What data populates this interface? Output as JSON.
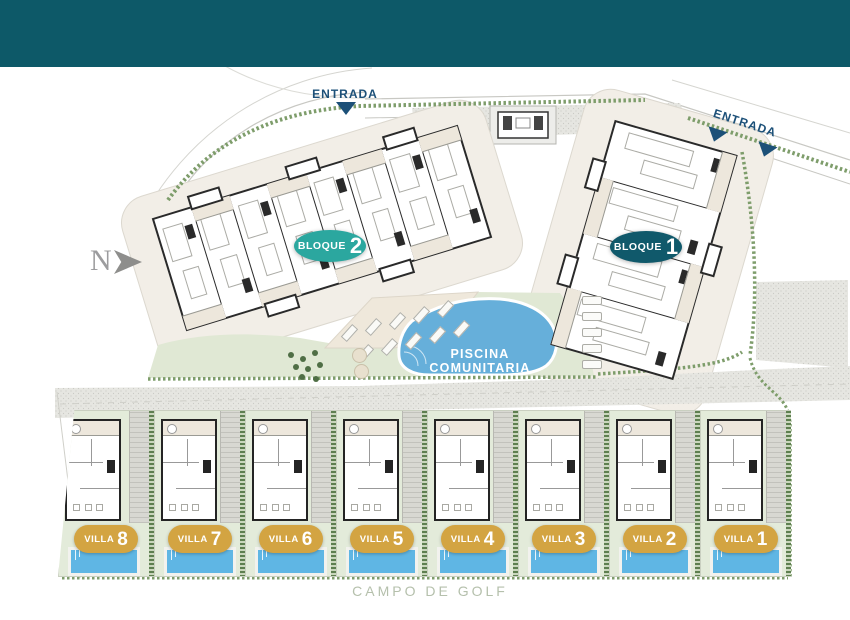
{
  "header": {
    "color": "#0D5968"
  },
  "compass": {
    "label": "N"
  },
  "entrances": [
    {
      "label": "ENTRADA"
    },
    {
      "label": "ENTRADA"
    }
  ],
  "blocks": [
    {
      "label": "BLOQUE",
      "number": "2",
      "color": "#2BA79F"
    },
    {
      "label": "BLOQUE",
      "number": "1",
      "color": "#10596B"
    }
  ],
  "pool": {
    "label": "PISCINA COMUNITARIA",
    "color": "#66AFDA"
  },
  "villas": [
    {
      "label": "VILLA",
      "number": "8"
    },
    {
      "label": "VILLA",
      "number": "7"
    },
    {
      "label": "VILLA",
      "number": "6"
    },
    {
      "label": "VILLA",
      "number": "5"
    },
    {
      "label": "VILLA",
      "number": "4"
    },
    {
      "label": "VILLA",
      "number": "3"
    },
    {
      "label": "VILLA",
      "number": "2"
    },
    {
      "label": "VILLA",
      "number": "1"
    }
  ],
  "villa_badge_color": "#D3A442",
  "golf": {
    "label": "CAMPO DE GOLF"
  },
  "accents": {
    "entrada_blue": "#1C5078",
    "hedge_green": "#7E9D6B",
    "lawn_green": "#E0E8D4",
    "villa_pool_blue": "#5FB6E4"
  }
}
